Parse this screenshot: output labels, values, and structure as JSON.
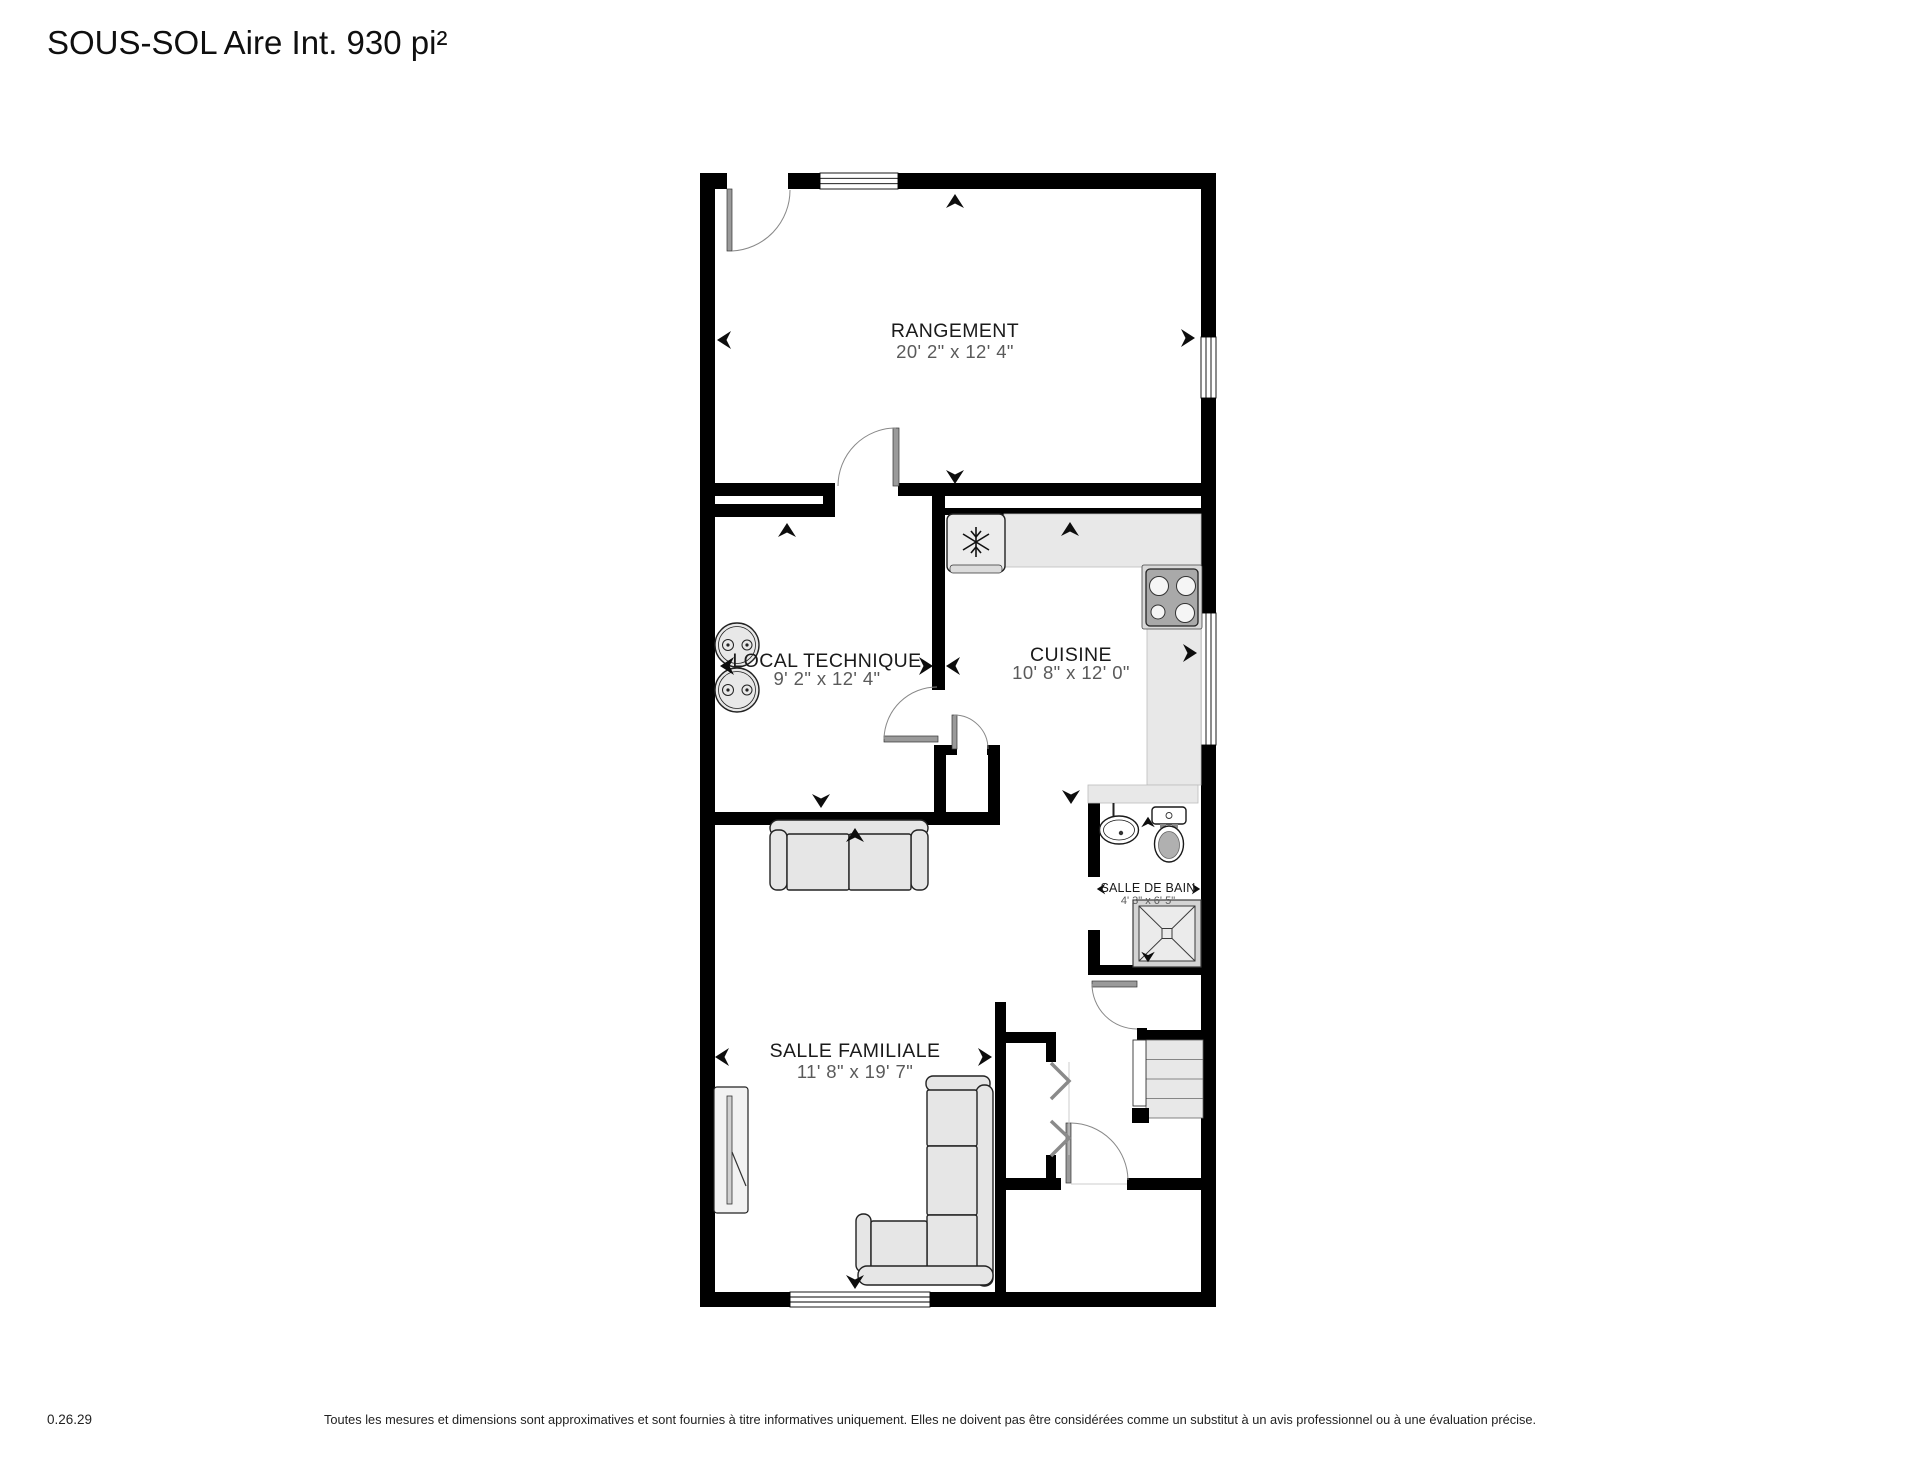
{
  "title": "SOUS-SOL Aire Int. 930 pi²",
  "rooms": {
    "rangement": {
      "name": "RANGEMENT",
      "dims": "20' 2\" x 12' 4\""
    },
    "local_technique": {
      "name": "LOCAL TECHNIQUE",
      "dims": "9' 2\" x 12' 4\""
    },
    "cuisine": {
      "name": "CUISINE",
      "dims": "10' 8\" x 12' 0\""
    },
    "salle_de_bain": {
      "name": "SALLE DE BAIN",
      "dims": "4' 3\" x 6' 5\""
    },
    "salle_familiale": {
      "name": "SALLE FAMILIALE",
      "dims": "11' 8\" x 19' 7\""
    }
  },
  "footer": {
    "version": "0.26.29",
    "disclaimer": "Toutes les mesures et dimensions sont approximatives et sont fournies à titre informatives uniquement. Elles ne doivent pas être considérées comme un substitut à un avis professionnel ou à une évaluation précise."
  },
  "colors": {
    "wall": "#000000",
    "counter": "#e8e8e8",
    "furniture": "#e6e6e6",
    "stove_top": "#a9a9a9",
    "label_primary": "#1a1a1a",
    "label_secondary": "#5a5a5a"
  }
}
